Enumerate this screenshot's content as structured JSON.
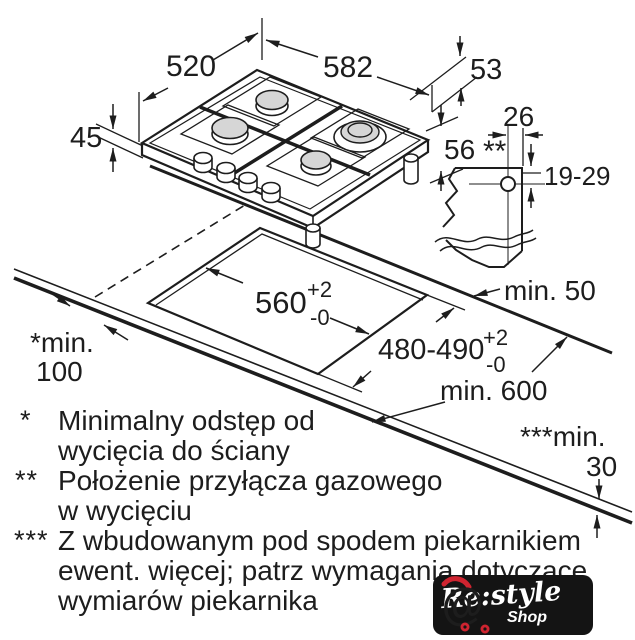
{
  "dims": {
    "hob_depth": "520",
    "hob_width": "582",
    "gas_side_offset": "53",
    "edge_height": "45",
    "below_worktop_depth": "56",
    "gas_offset_in_cutout": "26",
    "gas_depth_range": "19-29",
    "gas_marker": "**",
    "cutout_width": "560",
    "cutout_width_tol_plus": "+2",
    "cutout_width_tol_minus": "-0",
    "cutout_depth": "480-490",
    "cutout_depth_tol_plus": "+2",
    "cutout_depth_tol_minus": "-0",
    "rear_clearance": "min. 50",
    "worktop_depth": "min. 600",
    "wall_clearance_label": "*min.",
    "wall_clearance_value": "100",
    "worktop_thickness_label": "***min.",
    "worktop_thickness_value": "30"
  },
  "legend": {
    "items": [
      {
        "marker": "*",
        "lines": [
          "Minimalny odstęp od",
          "wycięcia do ściany"
        ]
      },
      {
        "marker": "**",
        "lines": [
          "Położenie przyłącza gazowego",
          "w wycięciu"
        ]
      },
      {
        "marker": "***",
        "lines": [
          "Z wbudowanym pod spodem piekarnikiem",
          "ewent. więcej; patrz wymagania dotyczące",
          "wymiarów piekarnika"
        ]
      }
    ]
  },
  "logo": {
    "brand": "Re:style",
    "sub": "Shop",
    "cart_at": "@"
  },
  "colors": {
    "line": "#1d1d1d",
    "burner_fill": "#d6d6d6",
    "logo_bg": "#141414",
    "logo_red": "#cf2430"
  }
}
